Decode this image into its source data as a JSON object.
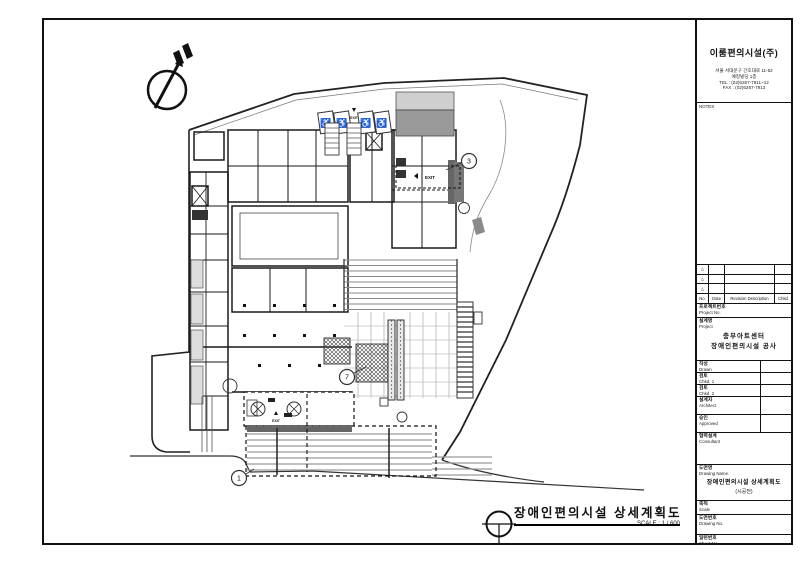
{
  "title_block": {
    "company": "이룸편의시설(주)",
    "address_lines": [
      "서울 서대문구 간호대로 11-52",
      "예정빌딩 1층",
      "TEL : (02)6267-7911~12",
      "FAX : (02)6267-7913"
    ],
    "notes_label": "NOTES",
    "revision": {
      "marker": "△",
      "columns": [
        "No.",
        "Date",
        "Revision Description",
        "Chkd"
      ]
    },
    "project_no": {
      "kr": "프로젝트번호",
      "en": "Project No."
    },
    "project": {
      "kr": "설계명",
      "en": "Project",
      "name_line1": "충무아트센터",
      "name_line2": "장애인편의시설 공사"
    },
    "fields": [
      {
        "kr": "작성",
        "en": "Drawn"
      },
      {
        "kr": "검토",
        "en": "Chkd. 1"
      },
      {
        "kr": "검토",
        "en": "Chkd. 2"
      },
      {
        "kr": "설계자",
        "en": "Architect"
      },
      {
        "kr": "승인",
        "en": "Approved"
      },
      {
        "kr": "협력설계",
        "en": "Consultant"
      }
    ],
    "drawing_name": {
      "kr": "도면명",
      "en": "Drawing Name.",
      "line1": "장애인편의시설 상세계획도",
      "line2": "(시공전)"
    },
    "scale": {
      "kr": "축척",
      "en": "Scale"
    },
    "drawing_no": {
      "kr": "도면번호",
      "en": "Drawing No."
    },
    "sheet_no": {
      "kr": "일련번호",
      "en": "Sheet No."
    }
  },
  "drawing": {
    "title": "장애인편의시설 상세계획도",
    "scale_note": "SCALE : 1 / 600",
    "callouts": [
      "1",
      "3",
      "7"
    ],
    "exit_label": "EXIT",
    "wheelchair_symbol": "♿"
  }
}
